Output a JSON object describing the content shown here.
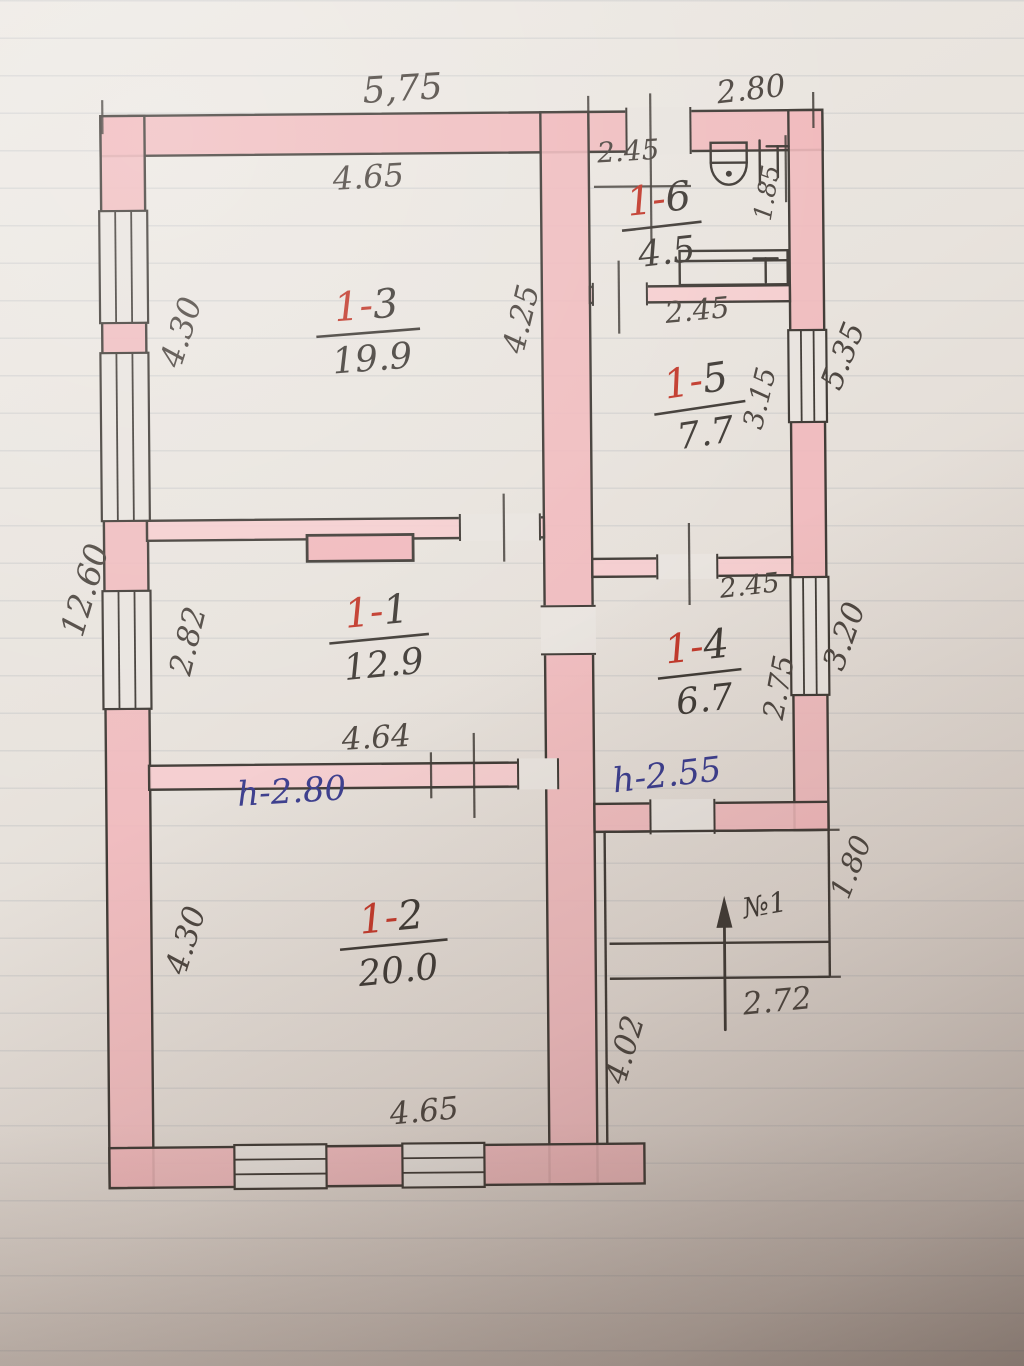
{
  "palette": {
    "paper": "#e9e4df",
    "pencil": "#413c37",
    "pencil_soft": "#4e4741",
    "red_ink": "#c23a2c",
    "blue_ink": "#3c3e8e",
    "wall_pink": "#f1b9bd",
    "wall_pink_light": "#f6ccce"
  },
  "plan": {
    "rooms": [
      {
        "id_prefix": "1-",
        "id_suffix": "3",
        "area": "19.9",
        "x": 370,
        "y": 318,
        "rot": -4,
        "bar_w": 104
      },
      {
        "id_prefix": "1-",
        "id_suffix": "6",
        "area": "4.5",
        "x": 664,
        "y": 214,
        "rot": -6,
        "bar_w": 80
      },
      {
        "id_prefix": "1-",
        "id_suffix": "5",
        "area": "7.7",
        "x": 700,
        "y": 396,
        "rot": -8,
        "bar_w": 92
      },
      {
        "id_prefix": "1-",
        "id_suffix": "1",
        "area": "12.9",
        "x": 378,
        "y": 624,
        "rot": -5,
        "bar_w": 100
      },
      {
        "id_prefix": "1-",
        "id_suffix": "4",
        "area": "6.7",
        "x": 698,
        "y": 662,
        "rot": -6,
        "bar_w": 84
      },
      {
        "id_prefix": "1-",
        "id_suffix": "2",
        "area": "20.0",
        "x": 390,
        "y": 930,
        "rot": -5,
        "bar_w": 108
      }
    ],
    "dims": [
      {
        "t": "5,75",
        "x": 408,
        "y": 100,
        "r": -3,
        "s": 36
      },
      {
        "t": "2.80",
        "x": 757,
        "y": 102,
        "r": -6,
        "s": 31
      },
      {
        "t": "4.65",
        "x": 373,
        "y": 187,
        "r": -3,
        "s": 32
      },
      {
        "t": "2.45",
        "x": 633,
        "y": 162,
        "r": -3,
        "s": 28
      },
      {
        "t": "1.85",
        "x": 779,
        "y": 197,
        "r": -80,
        "s": 25
      },
      {
        "t": "4.30",
        "x": 194,
        "y": 333,
        "r": -72,
        "s": 32
      },
      {
        "t": "4.25",
        "x": 534,
        "y": 322,
        "r": -76,
        "s": 31
      },
      {
        "t": "2.45",
        "x": 701,
        "y": 322,
        "r": -5,
        "s": 29
      },
      {
        "t": "5.35",
        "x": 855,
        "y": 363,
        "r": -68,
        "s": 31
      },
      {
        "t": "3.15",
        "x": 771,
        "y": 403,
        "r": -76,
        "s": 28
      },
      {
        "t": "12.60",
        "x": 96,
        "y": 590,
        "r": -73,
        "s": 33
      },
      {
        "t": "2.82",
        "x": 198,
        "y": 641,
        "r": -76,
        "s": 31
      },
      {
        "t": "2.45",
        "x": 751,
        "y": 597,
        "r": -6,
        "s": 27
      },
      {
        "t": "3.20",
        "x": 854,
        "y": 643,
        "r": -70,
        "s": 31
      },
      {
        "t": "2.75",
        "x": 788,
        "y": 692,
        "r": -79,
        "s": 29
      },
      {
        "t": "4.64",
        "x": 376,
        "y": 747,
        "r": -3,
        "s": 31
      },
      {
        "t": "1.80",
        "x": 858,
        "y": 874,
        "r": -68,
        "s": 29
      },
      {
        "t": "4.30",
        "x": 193,
        "y": 941,
        "r": -72,
        "s": 31
      },
      {
        "t": "2.72",
        "x": 775,
        "y": 1014,
        "r": -5,
        "s": 31
      },
      {
        "t": "4.02",
        "x": 631,
        "y": 1054,
        "r": -73,
        "s": 31
      },
      {
        "t": "4.65",
        "x": 421,
        "y": 1121,
        "r": -5,
        "s": 31
      }
    ],
    "notes": [
      {
        "t": "h-2.80",
        "x": 291,
        "y": 801,
        "r": -3,
        "c": "blue",
        "s": 34
      },
      {
        "t": "h-2.55",
        "x": 667,
        "y": 788,
        "r": -6,
        "c": "blue",
        "s": 34
      },
      {
        "t": "№1",
        "x": 764,
        "y": 917,
        "r": -10,
        "c": "pencil",
        "s": 28
      }
    ],
    "walls": [
      {
        "x": 105,
        "y": 113,
        "w": 722,
        "h": 40
      },
      {
        "x": 105,
        "y": 113,
        "w": 44,
        "h": 1072
      },
      {
        "x": 545,
        "y": 113,
        "w": 48,
        "h": 1072
      },
      {
        "x": 105,
        "y": 1145,
        "w": 535,
        "h": 40
      },
      {
        "x": 793,
        "y": 113,
        "w": 34,
        "h": 720
      },
      {
        "x": 148,
        "y": 518,
        "w": 397,
        "h": 20,
        "f": "b"
      },
      {
        "x": 148,
        "y": 763,
        "w": 397,
        "h": 24,
        "f": "b"
      },
      {
        "x": 593,
        "y": 288,
        "w": 200,
        "h": 16,
        "f": "b"
      },
      {
        "x": 593,
        "y": 560,
        "w": 200,
        "h": 18,
        "f": "b"
      },
      {
        "x": 593,
        "y": 805,
        "w": 234,
        "h": 28
      }
    ],
    "windows": [
      {
        "x": 103,
        "y": 208,
        "w": 48,
        "h": 112,
        "o": "v"
      },
      {
        "x": 103,
        "y": 350,
        "w": 48,
        "h": 168,
        "o": "v"
      },
      {
        "x": 103,
        "y": 588,
        "w": 48,
        "h": 118,
        "o": "v"
      },
      {
        "x": 791,
        "y": 333,
        "w": 38,
        "h": 92,
        "o": "v"
      },
      {
        "x": 791,
        "y": 580,
        "w": 38,
        "h": 118,
        "o": "v"
      },
      {
        "x": 230,
        "y": 1143,
        "w": 92,
        "h": 44,
        "o": "h"
      },
      {
        "x": 398,
        "y": 1143,
        "w": 82,
        "h": 44,
        "o": "h"
      }
    ],
    "doors": [
      {
        "x": 630,
        "y": 109,
        "w": 66,
        "h": 47,
        "o": "h"
      },
      {
        "x": 595,
        "y": 284,
        "w": 56,
        "h": 23,
        "o": "h"
      },
      {
        "x": 657,
        "y": 556,
        "w": 62,
        "h": 25,
        "o": "h"
      },
      {
        "x": 460,
        "y": 514,
        "w": 82,
        "h": 27,
        "o": "h"
      },
      {
        "x": 541,
        "y": 606,
        "w": 55,
        "h": 50,
        "o": "v"
      },
      {
        "x": 516,
        "y": 759,
        "w": 42,
        "h": 31,
        "o": "h"
      },
      {
        "x": 648,
        "y": 801,
        "w": 66,
        "h": 35,
        "o": "h"
      }
    ],
    "ticks": [
      [
        655,
        95,
        655,
        245
      ],
      [
        790,
        138,
        790,
        205
      ],
      [
        598,
        188,
        695,
        188
      ],
      [
        622,
        262,
        622,
        335
      ],
      [
        690,
        525,
        690,
        607
      ],
      [
        505,
        494,
        505,
        562
      ],
      [
        473,
        733,
        473,
        818
      ],
      [
        430,
        752,
        430,
        798
      ],
      [
        107,
        97,
        107,
        131
      ],
      [
        593,
        97,
        593,
        131
      ],
      [
        818,
        95,
        818,
        131
      ],
      [
        815,
        833,
        838,
        833
      ],
      [
        815,
        980,
        838,
        980
      ]
    ],
    "porch": [
      [
        603,
        833,
        827,
        833
      ],
      [
        827,
        833,
        827,
        980
      ],
      [
        607,
        945,
        827,
        945
      ],
      [
        607,
        980,
        827,
        980
      ],
      [
        603,
        833,
        603,
        1145
      ]
    ],
    "icons": [
      "toilet-icon",
      "tap-icon",
      "bath-icon",
      "stove-icon",
      "entrance-arrow-icon"
    ]
  }
}
